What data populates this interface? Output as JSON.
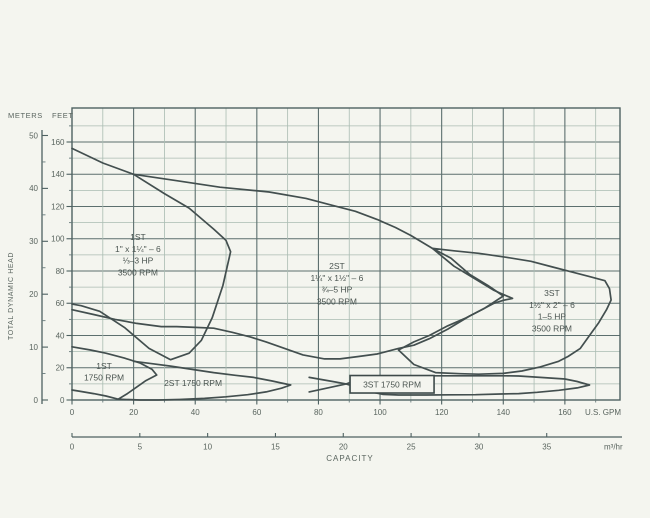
{
  "page": {
    "background": "#f4f5ef"
  },
  "labels": {
    "meters": "METERS",
    "feet": "FEET",
    "tdh": "TOTAL DYNAMIC HEAD",
    "us_gpm": "U.S. GPM",
    "m3hr": "m³/hr",
    "capacity": "CAPACITY"
  },
  "colors": {
    "paper": "#f4f5ef",
    "grid_major": "#5c6f6e",
    "grid_minor": "#aabcb2",
    "curve": "#434f4f",
    "text": "#5a655f"
  },
  "chart_data": {
    "type": "area",
    "title": "",
    "xlabel": "CAPACITY",
    "ylabel": "TOTAL DYNAMIC HEAD",
    "grid": "on",
    "x_axis_primary": {
      "unit": "U.S. GPM",
      "ticks": [
        0,
        20,
        40,
        60,
        80,
        100,
        120,
        140,
        160
      ],
      "minor_step": 10,
      "range": [
        0,
        178
      ]
    },
    "x_axis_secondary": {
      "unit": "m³/hr",
      "ticks": [
        0,
        5,
        10,
        15,
        20,
        25,
        30,
        35
      ],
      "gpm_per_unit": 4.403
    },
    "y_axis_primary": {
      "unit": "FEET",
      "ticks": [
        0,
        20,
        40,
        60,
        80,
        100,
        120,
        140,
        160
      ],
      "minor_step": 10,
      "range": [
        0,
        181
      ]
    },
    "y_axis_secondary": {
      "unit": "METERS",
      "ticks": [
        0,
        10,
        20,
        30,
        40,
        50
      ],
      "feet_per_unit": 3.2808
    },
    "series": [
      {
        "id": "1st-3500",
        "label_lines": [
          "1ST",
          "1\" x 1¼\" – 6",
          "⅓–3 HP",
          "3500 RPM"
        ],
        "label_anchor": [
          21.4,
          90
        ],
        "boxed": false,
        "outline_gpm_ft": [
          [
            0,
            156
          ],
          [
            10,
            147
          ],
          [
            20,
            140
          ],
          [
            30,
            128
          ],
          [
            38,
            119
          ],
          [
            46,
            106
          ],
          [
            50,
            99
          ],
          [
            51.5,
            92
          ],
          [
            49,
            71
          ],
          [
            45.5,
            51
          ],
          [
            42,
            37
          ],
          [
            38,
            29
          ],
          [
            32,
            25
          ],
          [
            25,
            32
          ],
          [
            17,
            45
          ],
          [
            9,
            55
          ],
          [
            3,
            58.5
          ],
          [
            0,
            59.5
          ]
        ]
      },
      {
        "id": "2st-3500",
        "label_lines": [
          "2ST",
          "1¼\" x 1½\" – 6",
          "¾–5 HP",
          "3500 RPM"
        ],
        "label_anchor": [
          86,
          72
        ],
        "boxed": false,
        "outline_gpm_ft": [
          [
            20,
            140
          ],
          [
            34,
            136
          ],
          [
            48,
            132
          ],
          [
            64,
            129
          ],
          [
            76,
            125
          ],
          [
            84,
            121
          ],
          [
            92,
            117
          ],
          [
            99,
            112
          ],
          [
            105,
            107
          ],
          [
            110,
            102
          ],
          [
            117,
            94
          ],
          [
            123,
            88
          ],
          [
            129,
            78
          ],
          [
            135,
            71
          ],
          [
            140,
            64.5
          ],
          [
            134,
            57
          ],
          [
            129,
            52
          ],
          [
            122,
            44
          ],
          [
            116,
            38
          ],
          [
            111,
            34
          ],
          [
            106,
            32
          ],
          [
            99,
            28.5
          ],
          [
            93,
            27
          ],
          [
            87,
            25.5
          ],
          [
            82,
            25.5
          ],
          [
            75,
            28
          ],
          [
            69,
            32
          ],
          [
            63,
            36
          ],
          [
            58,
            39
          ],
          [
            52,
            42
          ],
          [
            46,
            44.5
          ],
          [
            40,
            45
          ],
          [
            34,
            45.5
          ],
          [
            29,
            45.5
          ],
          [
            21,
            47.5
          ],
          [
            14,
            50
          ],
          [
            7,
            53
          ],
          [
            0,
            56
          ]
        ]
      },
      {
        "id": "3st-3500",
        "label_lines": [
          "3ST",
          "1½\" x 2\" – 6",
          "1–5 HP",
          "3500 RPM"
        ],
        "label_anchor": [
          155.8,
          55.2
        ],
        "boxed": false,
        "outline_gpm_ft": [
          [
            143,
            63
          ],
          [
            137,
            68
          ],
          [
            131,
            75
          ],
          [
            124,
            83
          ],
          [
            117,
            94
          ],
          [
            124,
            92.5
          ],
          [
            132,
            91
          ],
          [
            141,
            88.5
          ],
          [
            149,
            86
          ],
          [
            156,
            82.5
          ],
          [
            163,
            79
          ],
          [
            168,
            76.5
          ],
          [
            173,
            74
          ],
          [
            174.5,
            69
          ],
          [
            175,
            62
          ],
          [
            173.5,
            56
          ],
          [
            171,
            48
          ],
          [
            168,
            40
          ],
          [
            165,
            32
          ],
          [
            161,
            27
          ],
          [
            158,
            24
          ],
          [
            152,
            20.5
          ],
          [
            146,
            18
          ],
          [
            140,
            16.5
          ],
          [
            132,
            16
          ],
          [
            126,
            16.3
          ],
          [
            118,
            17
          ],
          [
            111,
            22
          ],
          [
            106,
            31
          ],
          [
            111,
            36
          ],
          [
            116,
            40
          ],
          [
            122,
            46
          ],
          [
            128,
            51
          ],
          [
            133,
            56
          ],
          [
            137,
            60
          ],
          [
            140,
            61.8
          ],
          [
            143,
            63
          ]
        ]
      },
      {
        "id": "1st-1750",
        "label_lines": [
          "1ST",
          "1750 RPM"
        ],
        "label_anchor": [
          10.4,
          17.4
        ],
        "boxed": false,
        "outline_gpm_ft": [
          [
            0,
            33
          ],
          [
            6,
            31
          ],
          [
            11,
            29
          ],
          [
            17,
            26
          ],
          [
            22,
            23
          ],
          [
            26,
            19
          ],
          [
            27.5,
            15.5
          ],
          [
            24,
            12
          ],
          [
            21,
            8
          ],
          [
            18,
            4
          ],
          [
            15,
            0.5
          ],
          [
            11,
            2.5
          ],
          [
            7,
            4
          ],
          [
            3,
            5.3
          ],
          [
            0,
            6.2
          ]
        ]
      },
      {
        "id": "2st-1750",
        "label_lines": [
          "2ST 1750 RPM"
        ],
        "label_anchor": [
          39.3,
          10.5
        ],
        "boxed": false,
        "outline_gpm_ft": [
          [
            20,
            24
          ],
          [
            26,
            22.5
          ],
          [
            32,
            21
          ],
          [
            39,
            19
          ],
          [
            46,
            17
          ],
          [
            53,
            15.3
          ],
          [
            59,
            14
          ],
          [
            65,
            11.8
          ],
          [
            71,
            9.3
          ],
          [
            68,
            7.3
          ],
          [
            63,
            5
          ],
          [
            57,
            3.3
          ],
          [
            50,
            2
          ],
          [
            43,
            1
          ],
          [
            35,
            0.3
          ],
          [
            28,
            0
          ],
          [
            22,
            0
          ],
          [
            15,
            0.5
          ]
        ]
      },
      {
        "id": "3st-1750-notch",
        "label_lines": [],
        "label_anchor": null,
        "boxed": false,
        "outline_gpm_ft": [
          [
            77,
            14
          ],
          [
            83,
            12
          ],
          [
            89,
            10
          ],
          [
            83,
            7.5
          ],
          [
            77,
            5
          ]
        ]
      },
      {
        "id": "3st-1750",
        "label_lines": [
          "3ST 1750 RPM"
        ],
        "label_anchor": [
          103.9,
          9.6
        ],
        "boxed": true,
        "outline_gpm_ft": [
          [
            89,
            10
          ],
          [
            92,
            12
          ],
          [
            95,
            14
          ],
          [
            101,
            14.7
          ],
          [
            109,
            15
          ],
          [
            117,
            15
          ],
          [
            125,
            15
          ],
          [
            133,
            15
          ],
          [
            141,
            15
          ],
          [
            145,
            14.9
          ],
          [
            152,
            14
          ],
          [
            160,
            13
          ],
          [
            164,
            11.5
          ],
          [
            168,
            9.3
          ],
          [
            164,
            7.5
          ],
          [
            158,
            6
          ],
          [
            151,
            4.8
          ],
          [
            145,
            4
          ],
          [
            139,
            3.7
          ],
          [
            131,
            3.3
          ],
          [
            123,
            3.2
          ],
          [
            115,
            3.1
          ],
          [
            106,
            3.1
          ],
          [
            101,
            3.5
          ],
          [
            97,
            5
          ],
          [
            93,
            7.5
          ],
          [
            89,
            10
          ]
        ]
      }
    ]
  }
}
